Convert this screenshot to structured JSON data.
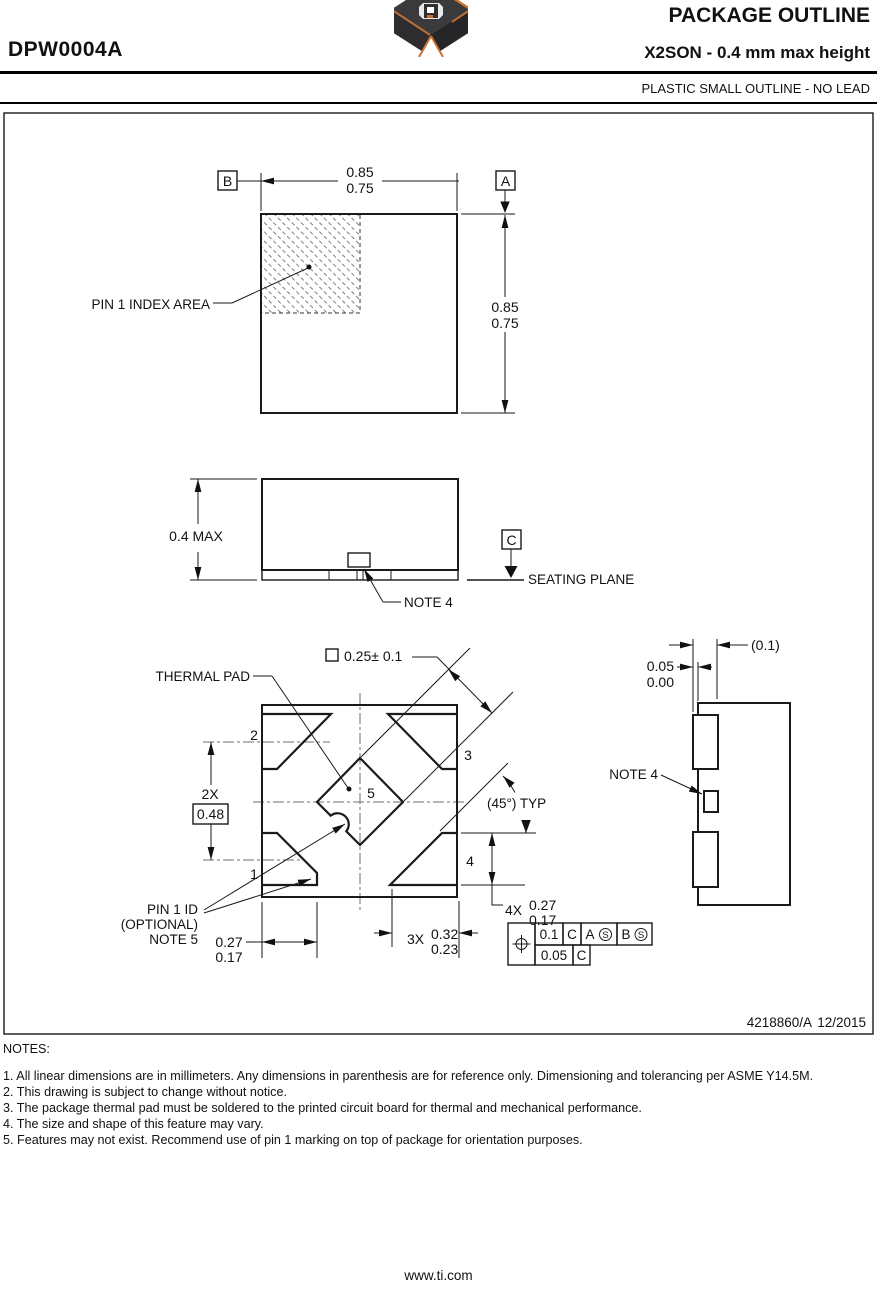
{
  "header": {
    "part_number": "DPW0004A",
    "title": "PACKAGE OUTLINE",
    "subtitle": "X2SON - 0.4 mm max height",
    "package_type": "PLASTIC SMALL OUTLINE - NO LEAD"
  },
  "top_view": {
    "datum_b": "B",
    "datum_a": "A",
    "width_upper": "0.85",
    "width_lower": "0.75",
    "height_upper": "0.85",
    "height_lower": "0.75",
    "pin1_index_label": "PIN 1 INDEX AREA"
  },
  "side_view": {
    "height_dim": "0.4 MAX",
    "datum_c": "C",
    "seating_plane_label": "SEATING PLANE",
    "note4_label": "NOTE 4"
  },
  "bottom_view": {
    "thermal_pad_label": "THERMAL PAD",
    "pad_size_dim": "0.25± 0.1",
    "pin1": "1",
    "pin2": "2",
    "pin3": "3",
    "pin4": "4",
    "pin5": "5",
    "dim_2x_qty": "2X",
    "dim_2x_value": "0.48",
    "angle_label": "(45°) TYP",
    "pin1_id_line1": "PIN 1 ID",
    "pin1_id_line2": "(OPTIONAL)",
    "pin1_id_line3": "NOTE 5",
    "dim_left_upper": "0.27",
    "dim_left_lower": "0.17",
    "dim_3x_qty": "3X",
    "dim_3x_upper": "0.32",
    "dim_3x_lower": "0.23",
    "dim_4x_qty": "4X",
    "dim_4x_upper": "0.27",
    "dim_4x_lower": "0.17",
    "fcf": {
      "tolerance1": "0.1",
      "datum_ref1": "C",
      "datum_ref2": "A",
      "modifier2": "S",
      "datum_ref3": "B",
      "modifier3": "S",
      "tolerance2": "0.05",
      "datum_ref4": "C"
    }
  },
  "detail_view": {
    "dim_ref": "(0.1)",
    "dim_upper": "0.05",
    "dim_lower": "0.00",
    "note4_label": "NOTE 4"
  },
  "title_block": {
    "drawing_number": "4218860/A",
    "date": "12/2015"
  },
  "notes": {
    "heading": "NOTES:",
    "items": [
      "1. All linear dimensions are in millimeters. Any dimensions in parenthesis are for reference only. Dimensioning and tolerancing per ASME Y14.5M.",
      "2. This drawing is subject to change without notice.",
      "3. The package thermal pad must be soldered to the printed circuit board for thermal and mechanical performance.",
      "4. The size and shape of this feature may vary.",
      "5. Features may not exist. Recommend use of pin 1 marking on top of package for orientation purposes."
    ]
  },
  "footer": {
    "url": "www.ti.com"
  },
  "colors": {
    "ink": "#111111",
    "logo_body": "#3a3a3c",
    "logo_accent": "#c9702e"
  }
}
